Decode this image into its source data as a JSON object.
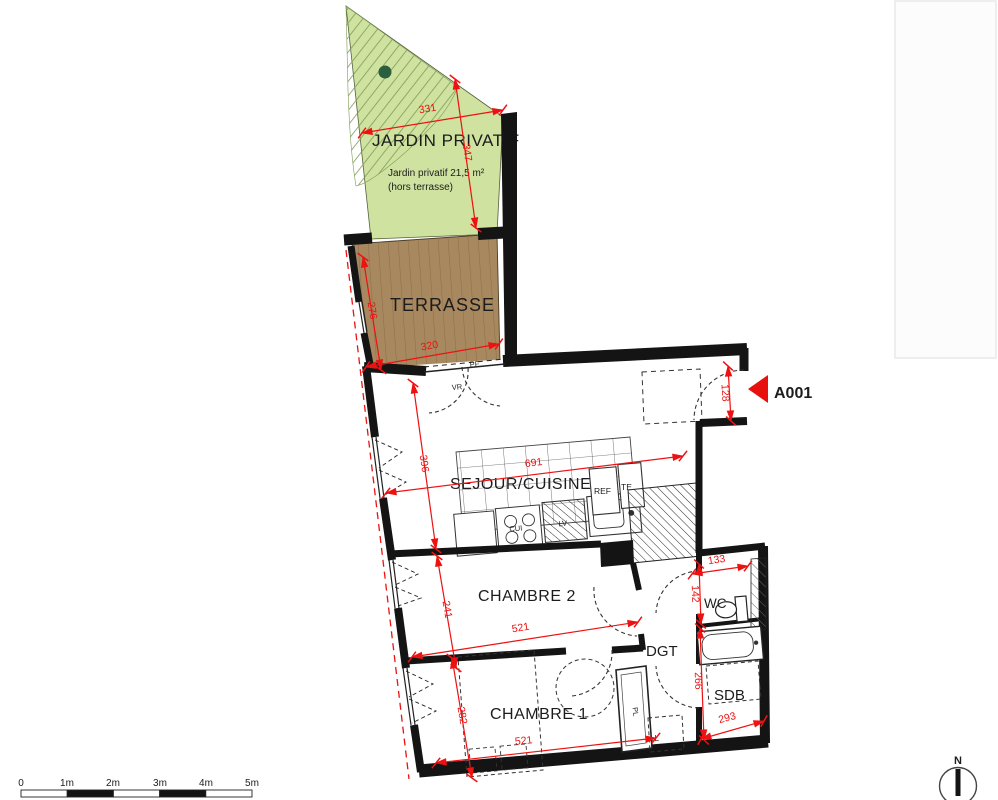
{
  "plan": {
    "garden": {
      "label": "JARDIN PRIVATIF",
      "area_line1": "Jardin privatif 21,5 m²",
      "area_line2": "(hors terrasse)"
    },
    "rooms": {
      "terrace": "TERRASSE",
      "living_kitchen": "SEJOUR/CUISINE",
      "bedroom2": "CHAMBRE 2",
      "bedroom1": "CHAMBRE 1",
      "hallway": "DGT",
      "wc": "WC",
      "bathroom": "SDB"
    },
    "fixtures": {
      "fridge": "REF",
      "electrical_panel": "TE",
      "cooktop": "CUI",
      "dishwasher": "LV",
      "wardrobe": "PL",
      "washing_machine": "LL",
      "french_door": "PF",
      "roller_shutter": "VR"
    },
    "entrance": {
      "label": "A001"
    },
    "dimensions_cm": {
      "garden_width": "331",
      "garden_depth": "347",
      "terrace_depth": "276",
      "terrace_width": "320",
      "living_depth": "396",
      "living_width": "691",
      "bedroom2_depth": "241",
      "bedroom2_width": "521",
      "bedroom1_depth": "282",
      "bedroom1_width": "521",
      "entry_width": "128",
      "wc_width": "133",
      "wc_depth": "142",
      "bathroom_depth": "266",
      "bathroom_width": "293"
    },
    "scale_bar": {
      "labels": [
        "0",
        "1m",
        "2m",
        "3m",
        "4m",
        "5m"
      ]
    },
    "compass": {
      "north_label": "N"
    },
    "colors": {
      "garden_fill": "#cfe2a0",
      "garden_hatch": "#7d9c55",
      "tree": "#2c5f40",
      "terrace_fill": "#a8885f",
      "terrace_planks": "#8d6f4c",
      "dimension_red": "#ee1111",
      "wall_black": "#141414",
      "entrance_arrow_red": "#e8100c"
    }
  }
}
